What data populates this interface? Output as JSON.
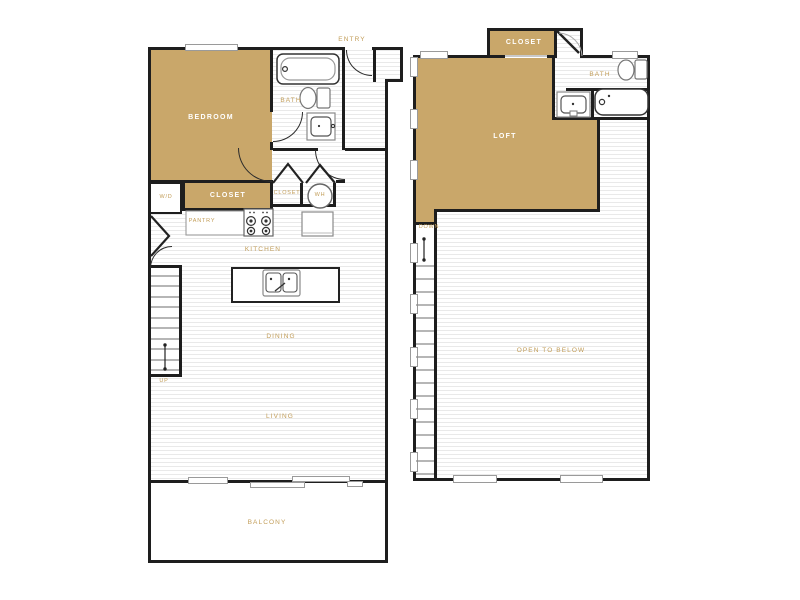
{
  "title": "Two-story loft floor plan",
  "colors": {
    "room_fill": "#c9a76a",
    "label_gold": "#c29d58",
    "wall": "#1e1e1e",
    "floor_stripe": "#e9e9e9"
  },
  "floor1": {
    "labels": {
      "entry": "ENTRY",
      "bedroom": "BEDROOM",
      "bath": "BATH",
      "closet": "CLOSET",
      "washer_dryer": "W/D",
      "pantry": "PANTRY",
      "closet_small": "CLOSET",
      "water_heater": "WH",
      "kitchen": "KITCHEN",
      "dining": "DINING",
      "living": "LIVING",
      "balcony": "BALCONY",
      "stairs": "UP"
    }
  },
  "floor2": {
    "labels": {
      "closet": "CLOSET",
      "loft": "LOFT",
      "bath": "BATH",
      "stairs": "DOWN",
      "open_to_below": "OPEN TO BELOW"
    }
  }
}
